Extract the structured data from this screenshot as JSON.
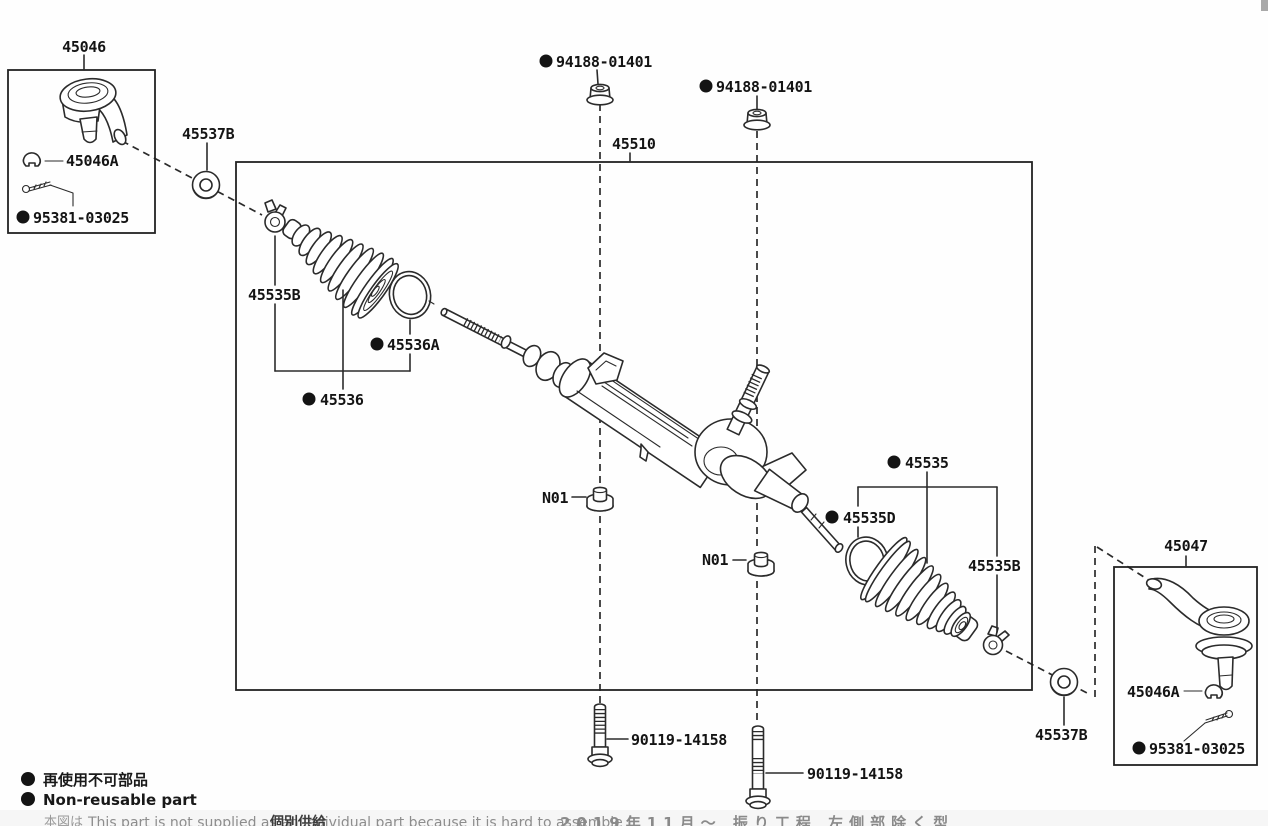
{
  "page": {
    "background": "#ffffff",
    "line_color": "#2b2b2b"
  },
  "assemblies": {
    "steering_gear": "45510",
    "tie_rod_end_left": "45046",
    "tie_rod_end_right": "45047"
  },
  "labels": {
    "l45046": "45046",
    "l45046A_left": "45046A",
    "l95381_left": "95381-03025",
    "l45537B_left": "45537B",
    "l94188_1": "94188-01401",
    "l94188_2": "94188-01401",
    "l45510": "45510",
    "l45535B_left": "45535B",
    "l45536A": "45536A",
    "l45536": "45536",
    "lN01_1": "N01",
    "lN01_2": "N01",
    "l45535": "45535",
    "l45535D": "45535D",
    "l45535B_right": "45535B",
    "l45047": "45047",
    "l45046A_right": "45046A",
    "l95381_right": "95381-03025",
    "l45537B_right": "45537B",
    "l90119_1": "90119-14158",
    "l90119_2": "90119-14158"
  },
  "legend": {
    "cjk": "再使用不可部品",
    "en": "Non-reusable part"
  },
  "footnote": {
    "prefix_cjk": "本図は",
    "en": "This part is not supplied as an individual part because it is hard to assemble (",
    "overlay_cjk": "個別供給",
    "suffix_cjk": "2019年11月～ 振り工程 左側部除く型"
  }
}
